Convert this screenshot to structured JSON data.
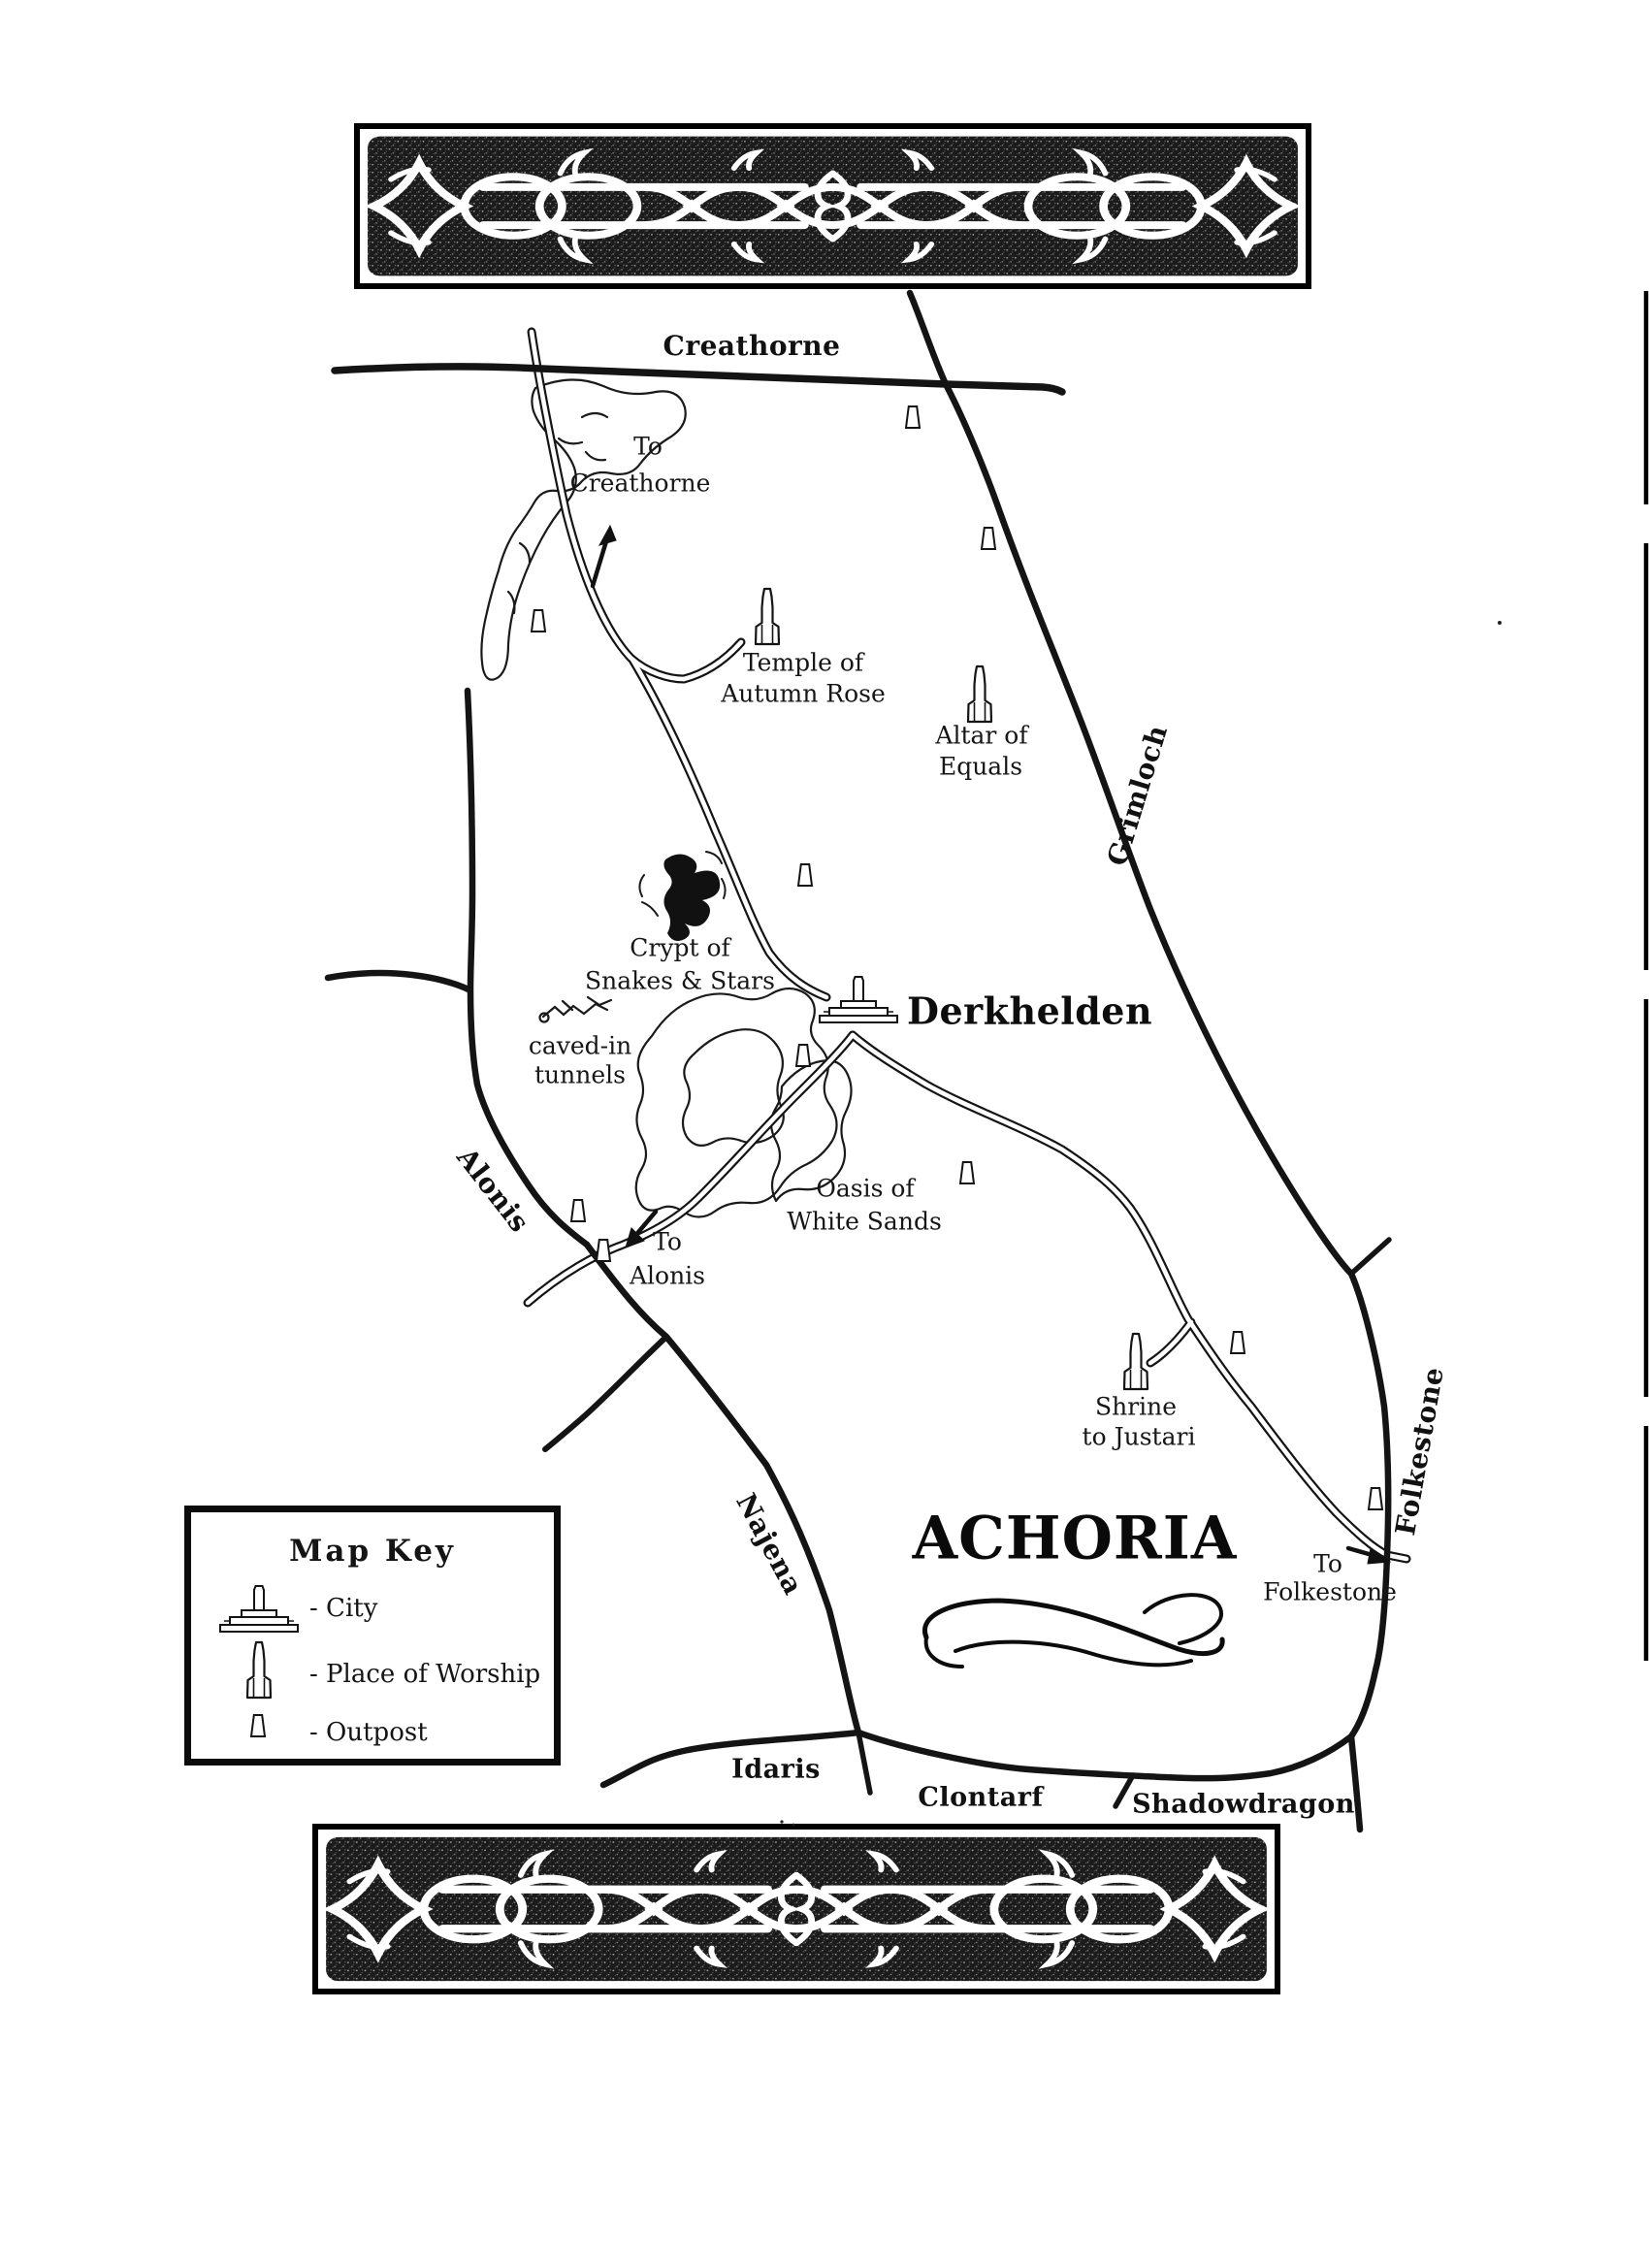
{
  "page": {
    "background": "#ffffff",
    "ink": "#141414"
  },
  "title": {
    "text": "ACHORIA"
  },
  "banners": {
    "top": "celtic-knotwork-band",
    "bottom": "celtic-knotwork-band"
  },
  "city": {
    "label": "Derkhelden"
  },
  "regions": {
    "creathorne": "Creathorne",
    "grimloch": "Grimloch",
    "alonis": "Alonis",
    "najena": "Najena",
    "folkestone": "Folkestone",
    "idaris": "Idaris",
    "clontarf": "Clontarf",
    "shadowdragon": "Shadowdragon"
  },
  "locations": {
    "temple": {
      "line1": "Temple of",
      "line2": "Autumn Rose",
      "type": "place-of-worship"
    },
    "altar": {
      "line1": "Altar of",
      "line2": "Equals",
      "type": "place-of-worship"
    },
    "shrine": {
      "line1": "Shrine",
      "line2": "to Justari",
      "type": "place-of-worship"
    },
    "crypt": {
      "line1": "Crypt of",
      "line2": "Snakes & Stars",
      "type": "landmark"
    },
    "tunnels": {
      "line1": "caved-in",
      "line2": "tunnels",
      "type": "landmark"
    },
    "oasis": {
      "line1": "Oasis of",
      "line2": "White Sands",
      "type": "landmark"
    }
  },
  "directions": {
    "creathorne": {
      "line1": "To",
      "line2": "Creathorne"
    },
    "alonis": {
      "line1": "To",
      "line2": "Alonis"
    },
    "folkestone": {
      "line1": "To",
      "line2": "Folkestone"
    }
  },
  "map_key": {
    "title": "Map Key",
    "items": [
      {
        "icon": "city-icon",
        "label": "- City"
      },
      {
        "icon": "place-of-worship-icon",
        "label": "- Place of Worship"
      },
      {
        "icon": "outpost-icon",
        "label": "- Outpost"
      }
    ]
  },
  "markers": {
    "outposts": [
      [
        941,
        430
      ],
      [
        1019,
        555
      ],
      [
        555,
        640
      ],
      [
        830,
        902
      ],
      [
        828,
        1088
      ],
      [
        997,
        1209
      ],
      [
        596,
        1248
      ],
      [
        622,
        1289
      ],
      [
        1276,
        1384
      ],
      [
        1418,
        1545
      ]
    ],
    "places_of_worship": [
      [
        791,
        642
      ],
      [
        1010,
        722
      ],
      [
        1171,
        1410
      ]
    ],
    "city": [
      [
        885,
        1035
      ]
    ]
  }
}
